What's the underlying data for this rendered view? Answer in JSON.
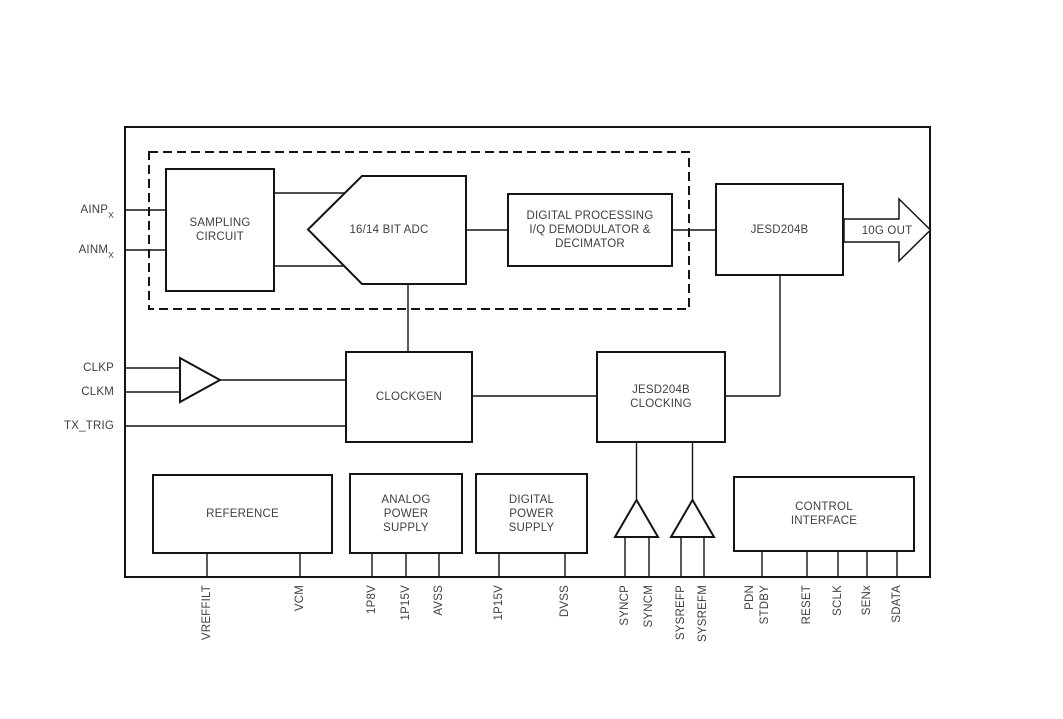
{
  "inputs": {
    "ainp_base": "AINP",
    "ainp_sub": "X",
    "ainm_base": "AINM",
    "ainm_sub": "X",
    "clkp": "CLKP",
    "clkm": "CLKM",
    "tx_trig": "TX_TRIG"
  },
  "blocks": {
    "sampling": "SAMPLING\nCIRCUIT",
    "adc": "16/14 BIT ADC",
    "digital_processing": "DIGITAL PROCESSING\nI/Q DEMODULATOR &\nDECIMATOR",
    "jesd204b": "JESD204B",
    "clockgen": "CLOCKGEN",
    "jesd_clocking": "JESD204B\nCLOCKING",
    "reference": "REFERENCE",
    "analog_power": "ANALOG\nPOWER\nSUPPLY",
    "digital_power": "DIGITAL\nPOWER\nSUPPLY",
    "control_interface": "CONTROL\nINTERFACE"
  },
  "output_label": "10G OUT",
  "pins": [
    "VREFFILT",
    "VCM",
    "1P8V",
    "1P15V",
    "AVSS",
    "1P15V",
    "DVSS",
    "SYNCP",
    "SYNCM",
    "SYSREFP",
    "SYSREFM",
    "PDN",
    "STDBY",
    "RESET",
    "SCLK",
    "SENx",
    "SDATA"
  ],
  "colors": {
    "line": "#141414",
    "text": "#3f3f3f",
    "background": "#ffffff"
  }
}
